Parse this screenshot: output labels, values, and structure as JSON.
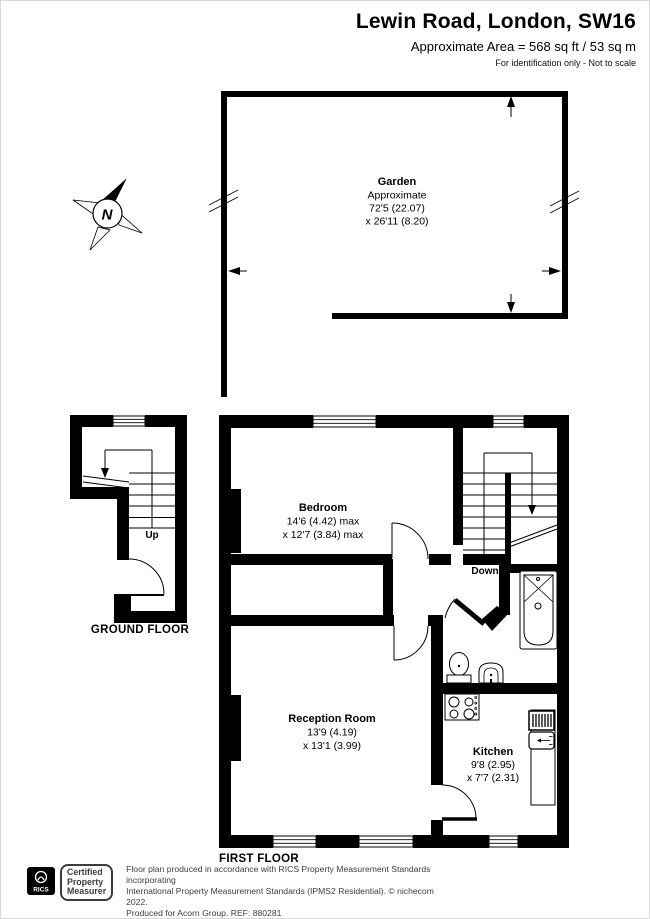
{
  "header": {
    "title": "Lewin Road, London, SW16",
    "area_line": "Approximate Area = 568 sq ft / 53 sq m",
    "disclaimer": "For identification only - Not to scale"
  },
  "compass": {
    "north_label": "N"
  },
  "garden": {
    "name": "Garden",
    "approx_label": "Approximate",
    "dim_line1": "72'5 (22.07)",
    "dim_line2": "x 26'11 (8.20)"
  },
  "ground_floor": {
    "caption": "GROUND FLOOR",
    "stair_direction": "Up"
  },
  "first_floor": {
    "caption": "FIRST FLOOR",
    "stair_direction": "Down",
    "bedroom": {
      "name": "Bedroom",
      "dim_line1": "14'6 (4.42) max",
      "dim_line2": "x 12'7 (3.84) max"
    },
    "reception": {
      "name": "Reception Room",
      "dim_line1": "13'9 (4.19)",
      "dim_line2": "x 13'1 (3.99)"
    },
    "kitchen": {
      "name": "Kitchen",
      "dim_line1": "9'8 (2.95)",
      "dim_line2": "x 7'7 (2.31)"
    }
  },
  "footer": {
    "rics_wordmark": "RICS",
    "badge_line1": "Certified",
    "badge_line2": "Property",
    "badge_line3": "Measurer",
    "text_line1": "Floor plan produced in accordance with RICS Property Measurement Standards incorporating",
    "text_line2": "International Property Measurement Standards (IPMS2 Residential).   © nichecom 2022.",
    "text_line3": "Produced for Acorn Group.   REF:  880281"
  },
  "colors": {
    "wall": "#000000",
    "background": "#ffffff",
    "footer_text": "#3d3d3d"
  }
}
